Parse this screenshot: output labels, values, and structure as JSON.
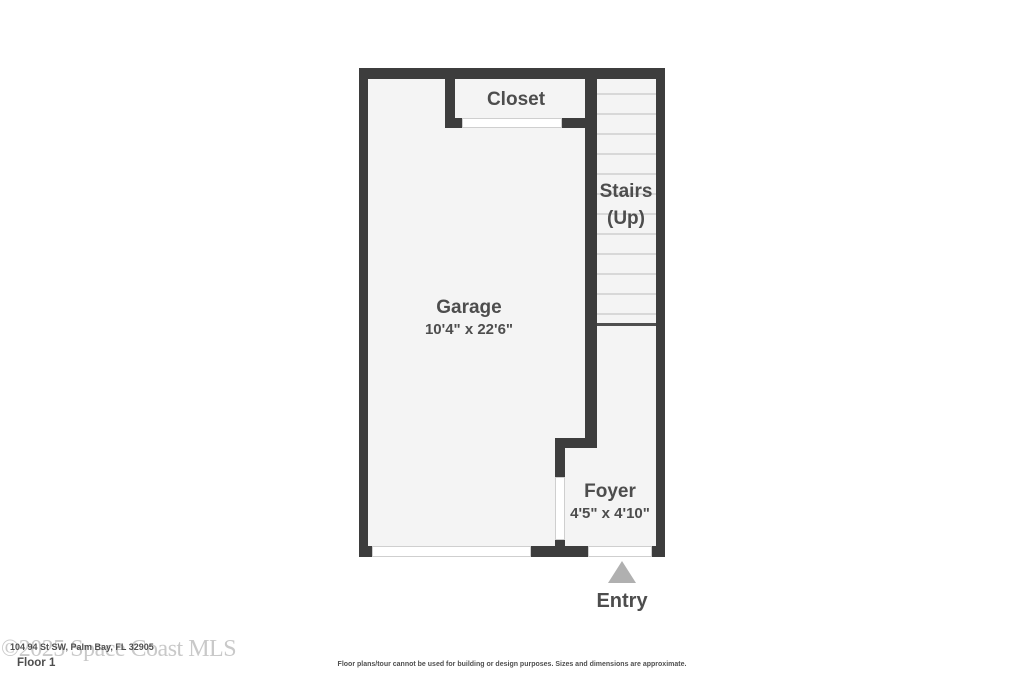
{
  "floorplan": {
    "rooms": {
      "closet": {
        "label": "Closet"
      },
      "stairs": {
        "label_line1": "Stairs",
        "label_line2": "(Up)"
      },
      "garage": {
        "label": "Garage",
        "dimensions": "10'4\" x 22'6\""
      },
      "foyer": {
        "label": "Foyer",
        "dimensions": "4'5\" x 4'10\""
      },
      "entry": {
        "label": "Entry"
      }
    },
    "stairs_tread_count": 12,
    "colors": {
      "wall": "#3d3d3d",
      "floor": "#f4f4f4",
      "tread_line": "#d8d8d8",
      "label": "#4d4d4d",
      "entry_arrow": "#b0b0b0",
      "watermark": "#c9c9c9"
    }
  },
  "footer": {
    "watermark": "©2025 Space Coast MLS",
    "address_overlay": "104 94 St SW, Palm Bay, FL 32905",
    "floor_label": "Floor 1",
    "disclaimer": "Floor plans/tour cannot be used for building or design purposes. Sizes and dimensions are approximate."
  }
}
